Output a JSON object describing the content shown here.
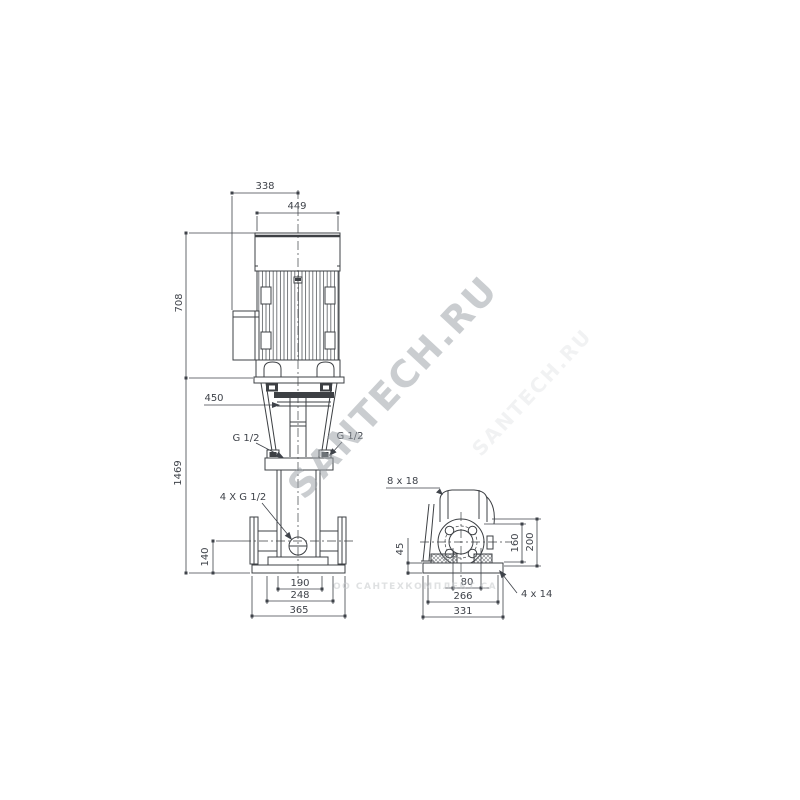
{
  "watermark": {
    "main": "SANTECH.RU",
    "strip": "ОО САНТЕХКОМПЛЕКТ СА"
  },
  "colors": {
    "line": "#3d4044",
    "dim_text": "#3f434a",
    "watermark": "#9aa0a6"
  },
  "labels": {
    "front": {
      "box_width": "338",
      "motor_width": "449",
      "motor_height": "708",
      "total_height": "1469",
      "clearance": "450",
      "port_left": "G 1/2",
      "port_right": "G 1/2",
      "gauge_ports": "4 X G 1/2",
      "port_center_height": "140",
      "base_inner_width": "190",
      "base_bolt_width": "248",
      "base_width": "365"
    },
    "side": {
      "stool_holes": "8 x 18",
      "base_height": "45",
      "depth_inner": "160",
      "depth_outer": "200",
      "port_offset": "80",
      "base_bolt_depth": "266",
      "base_depth": "331",
      "base_holes": "4 x 14"
    }
  }
}
